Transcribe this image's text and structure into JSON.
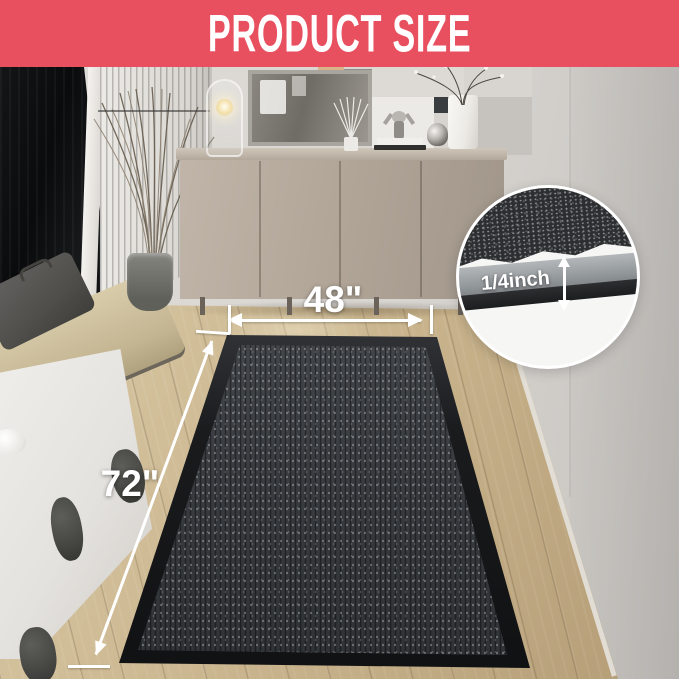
{
  "banner": {
    "title": "PRODUCT SIZE"
  },
  "dimensions": {
    "width": {
      "label": "48\""
    },
    "length": {
      "label": "72\""
    },
    "thickness": {
      "label": "1/4inch"
    }
  },
  "colors": {
    "banner_bg": "#e84f5f",
    "banner_text": "#ffffff",
    "annotation": "#ffffff",
    "mat_border": "#1a1b1d",
    "mat_surface": "#35383c",
    "floor_light": "#dcceae",
    "floor_dark": "#b49c75",
    "wall": "#d8d5d1",
    "cabinet": "#b0a597"
  }
}
